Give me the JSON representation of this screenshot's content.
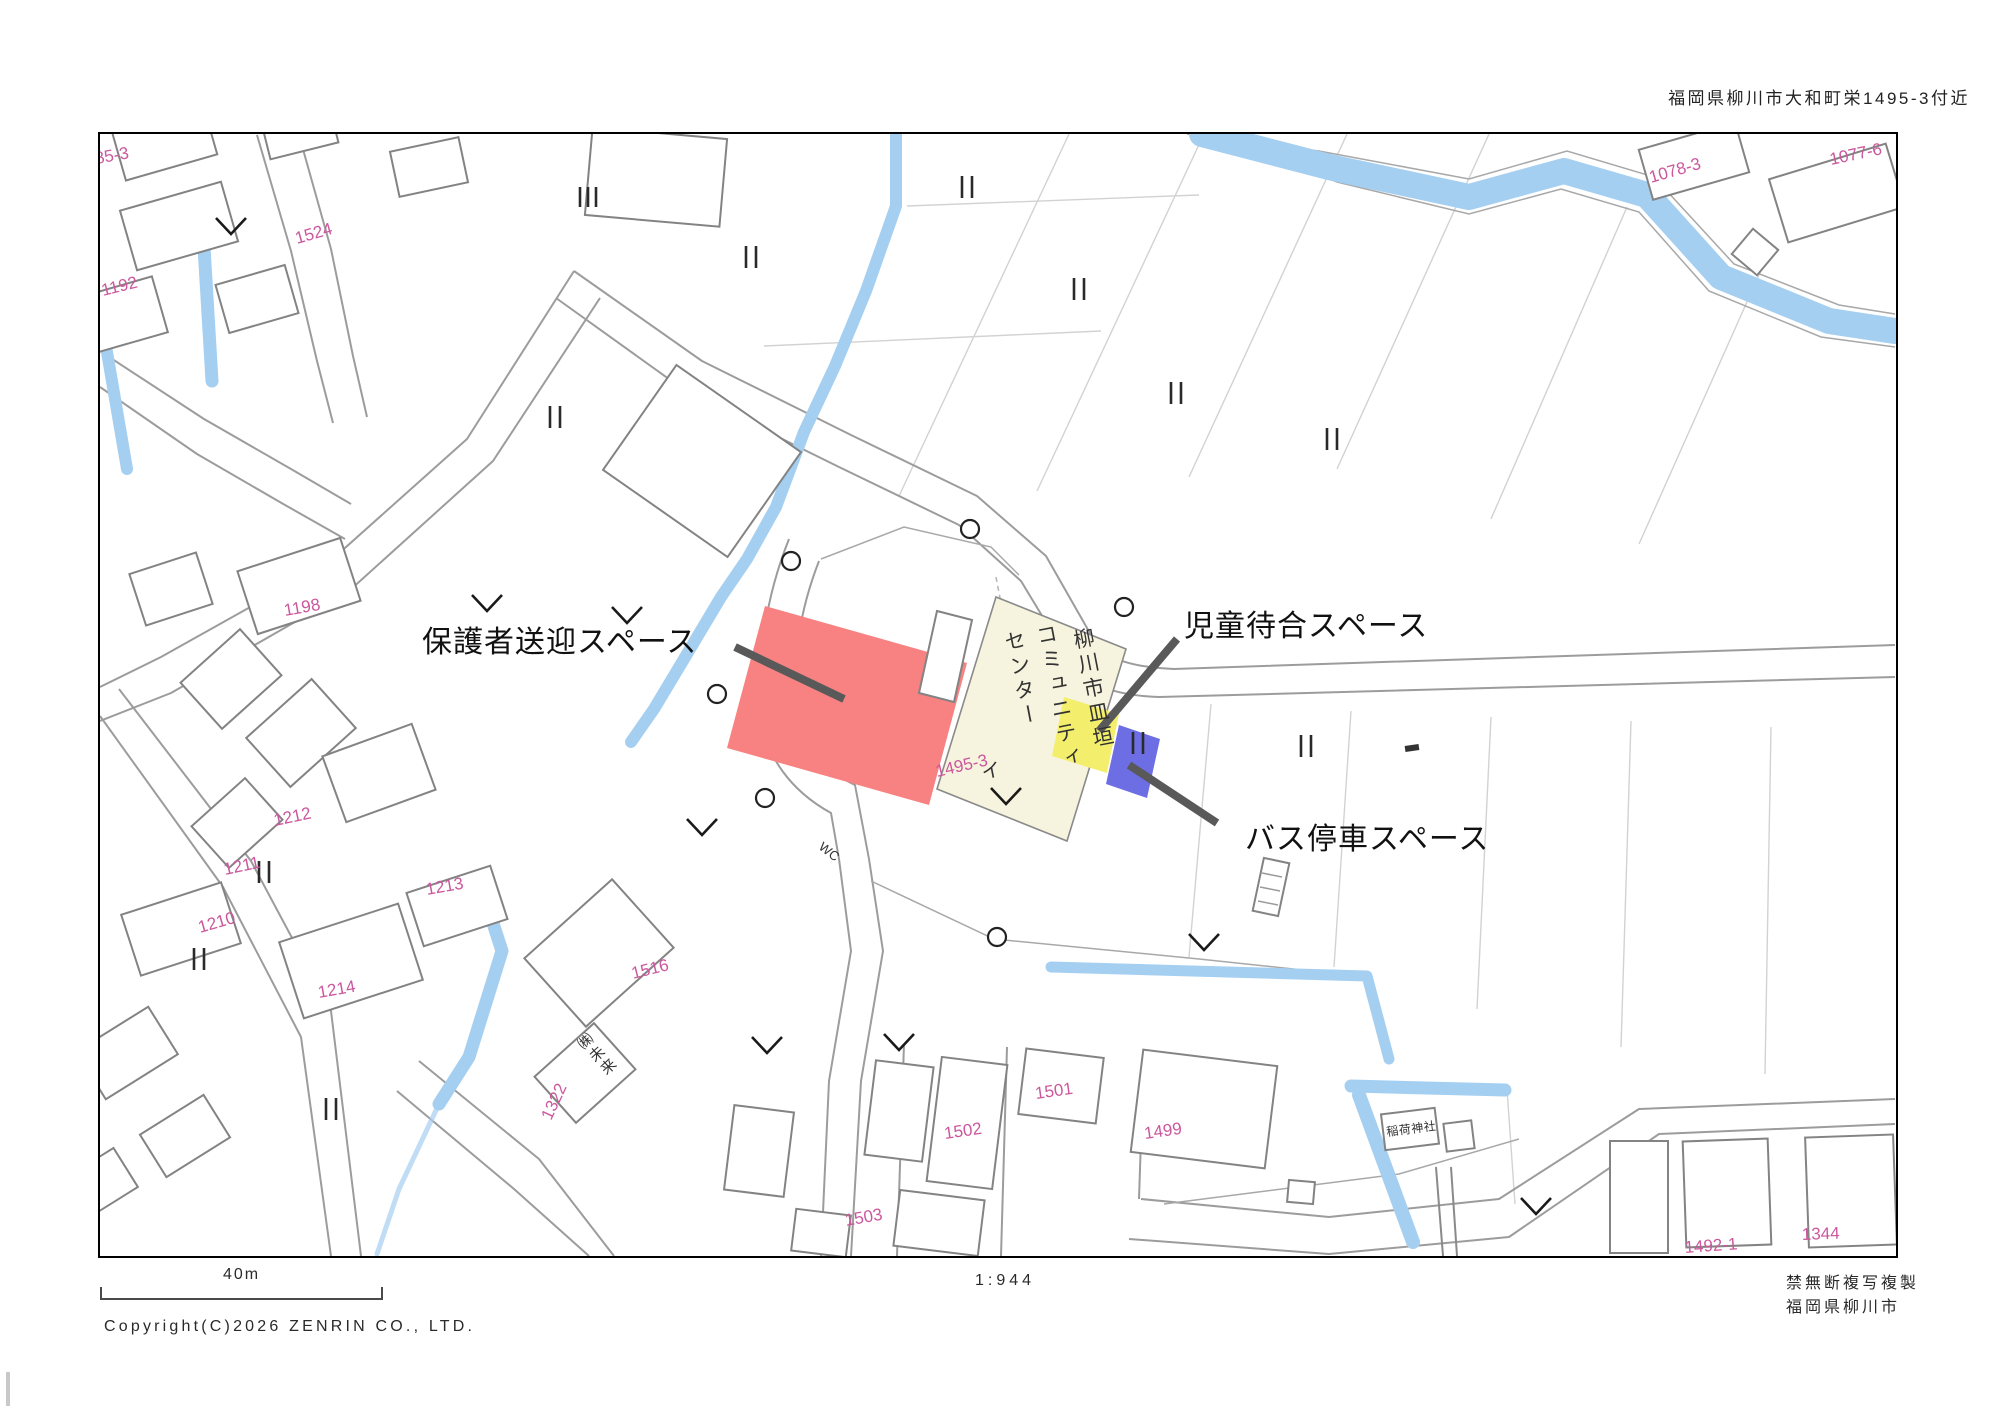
{
  "header": {
    "location_label": "福岡県柳川市大和町栄1495-3付近"
  },
  "map": {
    "annotations": {
      "guardian_pickup_label": "保護者送迎スペース",
      "children_waiting_label": "児童待合スペース",
      "bus_parking_label": "バス停車スペース"
    },
    "facility": {
      "name_column_right": "柳川市皿垣",
      "name_column_middle": "コミュニティ",
      "name_column_left": "センター",
      "parcel_number": "1495-3",
      "block_mark": "イ"
    },
    "places": {
      "toilet_label": "WC",
      "shrine_label": "稲荷神社",
      "company_label": "㈱未来",
      "company_parcel": "1322"
    },
    "parcel_numbers": [
      "85-3",
      "1524",
      "1192",
      "1198",
      "1212",
      "1211",
      "1210",
      "1213",
      "1214",
      "1516",
      "1502",
      "1501",
      "1499",
      "1503",
      "1492-1",
      "1344",
      "1078-3",
      "1077-6"
    ]
  },
  "footer": {
    "scale_distance_label": "40m",
    "scale_ratio_label": "1:944",
    "copyright_label": "Copyright(C)2026 ZENRIN CO., LTD.",
    "reproduction_notice": "禁無断複写複製",
    "city_credit": "福岡県柳川市"
  },
  "colors": {
    "parcel_number_text": "#cb579d",
    "pickup_area": "#f88181",
    "waiting_area": "#f3ef6d",
    "bus_area": "#6d6ee4",
    "facility_fill": "#f6f4de",
    "water": "#a5cff1",
    "annotation_line": "#595959"
  }
}
